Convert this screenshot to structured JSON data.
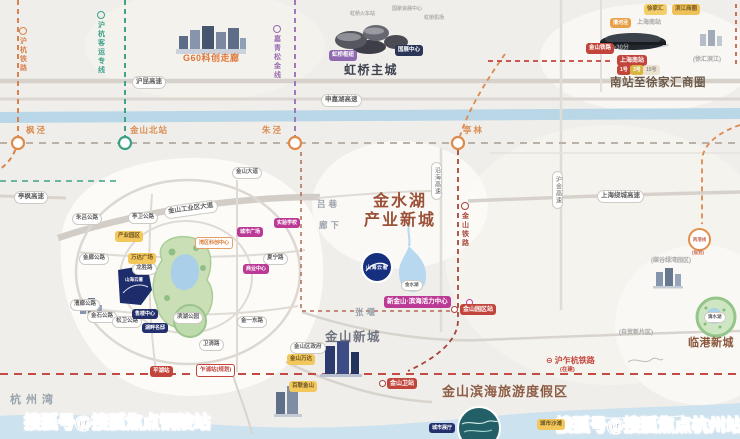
{
  "watermarks": {
    "left": "搜狐号@搜狐焦点铜陵站",
    "right": "搜狐号@搜狐焦点杭州站"
  },
  "regions": {
    "g60": "G60科创走廊",
    "hongqiao": "虹桥主城",
    "south_cbd": "南站至徐家汇商圈",
    "jinshuihu_l1": "金水湖",
    "jinshuihu_l2": "产业新城",
    "jinshan_city": "金山新城",
    "lingang": "临港新城",
    "binhai": "金山滨海旅游度假区",
    "hangzhou_bay": "杭州湾"
  },
  "special": {
    "huzhahang": {
      "label": "沪乍杭铁路",
      "note": "(在建)",
      "icon": "train-line-icon"
    },
    "lianggang": {
      "label": "两港线"
    },
    "project_logo": {
      "label": "山海云著"
    },
    "project_site": {
      "label": "山海云著"
    }
  },
  "colors": {
    "huhang_rail": "#d9824e",
    "huhang_hsr": "#43a189",
    "jiaqingsongjin": "#a078bc",
    "jinshan_rail": "#a8453c",
    "huzhahang_rail": "#c24c44",
    "metro_red": "#c2453c",
    "magenta_badge": "#bb3a96",
    "yellow_badge": "#f2c75c",
    "navy_badge": "#23306b",
    "lake_blue": "#a9d0e8",
    "park_green": "#cbdfb6",
    "sea_blue": "#cde2ef"
  },
  "texts": [
    {
      "t": "枫泾",
      "x": 26,
      "y": 126,
      "s": 8.5,
      "c": "#d98c52",
      "ls": 2,
      "n": "station-label-fengjing"
    },
    {
      "t": "金山北站",
      "x": 130,
      "y": 126,
      "s": 8.5,
      "c": "#d98c52",
      "ls": 1,
      "n": "station-label-jinshanbei"
    },
    {
      "t": "朱泾",
      "x": 262,
      "y": 126,
      "s": 8.5,
      "c": "#d98c52",
      "ls": 2,
      "n": "station-label-zhujing"
    },
    {
      "t": "亭林",
      "x": 463,
      "y": 126,
      "s": 8.5,
      "c": "#d98c52",
      "ls": 2,
      "n": "station-label-tinglin"
    },
    {
      "t": "吕巷",
      "x": 317,
      "y": 200,
      "s": 8.5,
      "c": "#9aa1ab",
      "ls": 3,
      "n": "town-label-luxiang"
    },
    {
      "t": "廊下",
      "x": 319,
      "y": 221,
      "s": 8.5,
      "c": "#9aa1ab",
      "ls": 3,
      "n": "town-label-langxia"
    },
    {
      "t": "张堰",
      "x": 355,
      "y": 308,
      "s": 8.5,
      "c": "#9aa1ab",
      "ls": 3,
      "n": "town-label-zhangyan"
    },
    {
      "t": "上海南站",
      "x": 637,
      "y": 20,
      "s": 6,
      "c": "#a6a6a6",
      "n": "label-south-station-small"
    },
    {
      "t": "≈30分",
      "x": 613,
      "y": 45,
      "s": 6,
      "c": "#9a9a9a",
      "n": "label-30min"
    },
    {
      "t": "(徐汇滨江)",
      "x": 693,
      "y": 57,
      "s": 6,
      "c": "#a8a8a8",
      "n": "label-xuhui-riverside"
    },
    {
      "t": "(碳谷绿湾园区)",
      "x": 651,
      "y": 258,
      "s": 6,
      "c": "#a8a8a8",
      "n": "label-tangu-park"
    },
    {
      "t": "(自贸新片区)",
      "x": 619,
      "y": 330,
      "s": 6,
      "c": "#a8a8a8",
      "n": "label-ftz-area"
    },
    {
      "t": "虹桥火车站",
      "x": 350,
      "y": 12,
      "s": 5,
      "c": "#b0aeac",
      "n": "label-hongqiao-railway"
    },
    {
      "t": "国家会展中心",
      "x": 392,
      "y": 7,
      "s": 5,
      "c": "#b0aeac",
      "n": "label-necc"
    },
    {
      "t": "虹桥机场",
      "x": 424,
      "y": 16,
      "s": 5,
      "c": "#b0aeac",
      "n": "label-hongqiao-airport"
    },
    {
      "t": "(规划)",
      "x": 692,
      "y": 251,
      "s": 4.5,
      "c": "#c9705a",
      "n": "label-lianggang-planned"
    }
  ],
  "vlabels": [
    {
      "t": "沪杭铁路",
      "x": 19,
      "y": 27,
      "c": "#d9824e",
      "n": "rail-label-huhang"
    },
    {
      "t": "沪杭客运专线",
      "x": 97,
      "y": 11,
      "c": "#3da189",
      "n": "rail-label-huhang-hsr"
    },
    {
      "t": "嘉青松金线",
      "x": 273,
      "y": 25,
      "c": "#9a6cb4",
      "n": "rail-label-jiaqingsongjin"
    },
    {
      "t": "金山铁路",
      "x": 461,
      "y": 202,
      "c": "#a8453c",
      "n": "rail-label-jinshan"
    },
    {
      "t": "沿海高速",
      "x": 431,
      "y": 162,
      "pill": true,
      "n": "road-label-yanhai-expwy"
    },
    {
      "t": "沪金高速",
      "x": 552,
      "y": 171,
      "pill": true,
      "n": "road-label-hujin-expwy"
    }
  ],
  "pills": [
    {
      "t": "沪昆高速",
      "x": 132,
      "y": 76,
      "n": "road-pill-hukun-expwy"
    },
    {
      "t": "申嘉湖高速",
      "x": 321,
      "y": 94,
      "n": "road-pill-shenjiahu-expwy"
    },
    {
      "t": "上海绕城高速",
      "x": 597,
      "y": 190,
      "n": "road-pill-raocheng-expwy"
    },
    {
      "t": "亭枫高速",
      "x": 14,
      "y": 191,
      "n": "road-pill-tingfeng-expwy"
    },
    {
      "t": "金山工业区大道",
      "x": 164,
      "y": 203,
      "r": -8,
      "n": "road-pill-industry-avenue"
    },
    {
      "t": "金山大道",
      "x": 232,
      "y": 167,
      "s": 5.5,
      "n": "road-pill-jinshan-avenue"
    },
    {
      "t": "亭卫公路",
      "x": 128,
      "y": 212,
      "s": 5.5,
      "n": "road-pill-tingwei"
    },
    {
      "t": "朱吕公路",
      "x": 72,
      "y": 213,
      "s": 5.5,
      "n": "road-pill-zhulv"
    },
    {
      "t": "金廊公路",
      "x": 79,
      "y": 253,
      "s": 5.5,
      "n": "road-pill-jinlang"
    },
    {
      "t": "漕廊公路",
      "x": 70,
      "y": 299,
      "s": 5.5,
      "n": "road-pill-caolang"
    },
    {
      "t": "金石公路",
      "x": 87,
      "y": 311,
      "s": 5.5,
      "n": "road-pill-jinshi"
    },
    {
      "t": "松卫公路",
      "x": 112,
      "y": 316,
      "s": 5.5,
      "n": "road-pill-songwei"
    },
    {
      "t": "龙胜路",
      "x": 132,
      "y": 263,
      "s": 5.5,
      "n": "road-pill-longsheng"
    },
    {
      "t": "夏宁路",
      "x": 263,
      "y": 253,
      "s": 5.5,
      "n": "road-pill-xianing"
    },
    {
      "t": "金一东路",
      "x": 237,
      "y": 316,
      "s": 5.5,
      "n": "road-pill-jinyi-east"
    },
    {
      "t": "卫清路",
      "x": 199,
      "y": 339,
      "s": 5.5,
      "n": "road-pill-weiqing"
    },
    {
      "t": "滨湖公园",
      "x": 173,
      "y": 312,
      "s": 5.5,
      "n": "poi-pill-lakeside-park"
    },
    {
      "t": "金水湖",
      "x": 401,
      "y": 280,
      "s": 4.5,
      "n": "poi-pill-jinshui-lake"
    },
    {
      "t": "滴水湖",
      "x": 704,
      "y": 312,
      "s": 4.5,
      "n": "poi-pill-dishui-lake"
    },
    {
      "t": "金山区政府",
      "x": 290,
      "y": 342,
      "s": 5.5,
      "n": "poi-pill-district-gov"
    }
  ],
  "badges": [
    {
      "t": "新金山·滨海活力中心",
      "x": 384,
      "y": 296,
      "s": 6.5,
      "bg": "#bb3a96",
      "n": "badge-vitality-center"
    },
    {
      "t": "实验学校",
      "x": 274,
      "y": 218,
      "s": 5,
      "bg": "#bb3a96",
      "n": "badge-school"
    },
    {
      "t": "城市广场",
      "x": 237,
      "y": 227,
      "s": 5,
      "bg": "#bb3a96",
      "n": "badge-city-plaza"
    },
    {
      "t": "商业中心",
      "x": 243,
      "y": 264,
      "s": 5,
      "bg": "#bb3a96",
      "n": "badge-commerce-center"
    },
    {
      "t": "产业园区",
      "x": 115,
      "y": 231,
      "s": 5.5,
      "bg": "#f2c75c",
      "c": "#6b5322",
      "n": "badge-industry-park"
    },
    {
      "t": "万达广场",
      "x": 128,
      "y": 253,
      "s": 5.5,
      "bg": "#f2c75c",
      "c": "#6b5322",
      "n": "badge-wanda-inset"
    },
    {
      "t": "金山万达",
      "x": 287,
      "y": 354,
      "s": 5.5,
      "bg": "#f2c75c",
      "c": "#6b5322",
      "n": "badge-jinshan-wanda"
    },
    {
      "t": "百联金山",
      "x": 289,
      "y": 381,
      "s": 5.5,
      "bg": "#f2c75c",
      "c": "#6b5322",
      "n": "badge-bailian"
    },
    {
      "t": "城市沙滩",
      "x": 537,
      "y": 419,
      "s": 5.5,
      "bg": "#f2c75c",
      "c": "#6b5322",
      "n": "badge-city-beach"
    },
    {
      "t": "湾区科创中心",
      "x": 195,
      "y": 237,
      "s": 5,
      "bg": "#ffffff",
      "c": "#d9782e",
      "bc": "#e2a066",
      "n": "badge-bay-tech-center"
    },
    {
      "t": "售楼中心",
      "x": 132,
      "y": 309,
      "s": 5,
      "bg": "#23306b",
      "n": "badge-sales-center"
    },
    {
      "t": "湖畔名邸",
      "x": 142,
      "y": 323,
      "s": 5,
      "bg": "#23306b",
      "n": "badge-residence"
    },
    {
      "t": "城市展厅",
      "x": 429,
      "y": 423,
      "s": 5,
      "bg": "#23306b",
      "n": "badge-city-hall"
    },
    {
      "t": "国展中心",
      "x": 395,
      "y": 45,
      "s": 5.5,
      "bg": "#2a3558",
      "n": "badge-necc-pill"
    },
    {
      "t": "虹桥枢纽",
      "x": 329,
      "y": 50,
      "s": 5.5,
      "bg": "#8f6ab0",
      "n": "badge-hongqiao-hub"
    },
    {
      "t": "金山园区站",
      "x": 460,
      "y": 304,
      "s": 6,
      "bg": "#c2453c",
      "n": "badge-yuanqu-station"
    },
    {
      "t": "金山卫站",
      "x": 387,
      "y": 378,
      "s": 6,
      "bg": "#c2453c",
      "n": "badge-jinshanwei-station"
    },
    {
      "t": "上海南站",
      "x": 617,
      "y": 55,
      "s": 6,
      "bg": "#c2453c",
      "n": "badge-shanghai-south-station"
    },
    {
      "t": "金山铁路",
      "x": 586,
      "y": 43,
      "s": 5.5,
      "bg": "#c2453c",
      "n": "badge-jinshan-railway"
    },
    {
      "t": "平湖站",
      "x": 150,
      "y": 366,
      "s": 5.5,
      "bg": "#c2453c",
      "n": "badge-pinghu-station"
    },
    {
      "t": "乍浦站(规划)",
      "x": 196,
      "y": 364,
      "s": 5.5,
      "bg": "#ffffff",
      "c": "#c2453c",
      "bc": "#c2453c",
      "n": "badge-zhapu-station"
    },
    {
      "t": "1号",
      "x": 617,
      "y": 65,
      "s": 5,
      "bg": "#c2453c",
      "n": "badge-metro-line-1"
    },
    {
      "t": "3号",
      "x": 630,
      "y": 65,
      "s": 5,
      "bg": "#d9b544",
      "n": "badge-metro-line-3"
    },
    {
      "t": "15号",
      "x": 643,
      "y": 65,
      "s": 5,
      "bg": "#eae3d1",
      "c": "#96918a",
      "n": "badge-metro-line-15"
    },
    {
      "t": "徐家汇",
      "x": 644,
      "y": 4,
      "s": 5.5,
      "bg": "#f2cf6a",
      "c": "#7a5c20",
      "n": "badge-xujiahui"
    },
    {
      "t": "滨江商圈",
      "x": 672,
      "y": 4,
      "s": 5.5,
      "bg": "#f0c05a",
      "c": "#7a5c20",
      "n": "badge-riverside-cbd"
    },
    {
      "t": "漕河泾",
      "x": 610,
      "y": 18,
      "s": 5,
      "bg": "#e8a04a",
      "n": "badge-caohejing"
    }
  ]
}
